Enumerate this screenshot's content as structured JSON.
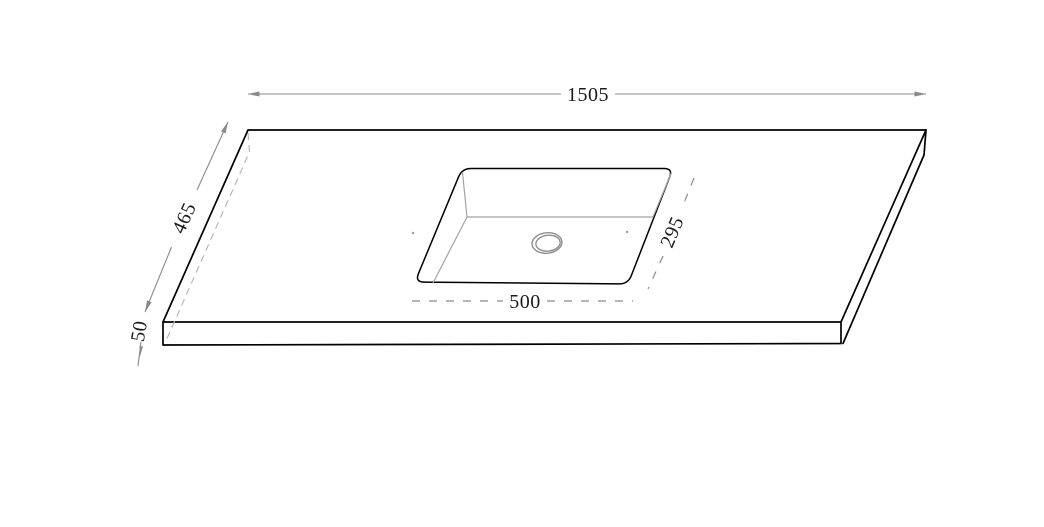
{
  "drawing": {
    "type": "countertop-with-undermount-sink-technical-drawing",
    "dimensions": {
      "overall_width": "1505",
      "overall_depth": "465",
      "thickness": "50",
      "sink_width": "500",
      "sink_depth": "295"
    },
    "colors": {
      "background": "#ffffff",
      "outline": "#000000",
      "dimension_line": "#8a8a8a",
      "hidden_edge": "#b8b8b8",
      "interior_edge": "#a3a3a3",
      "dimension_text": "#1b1b1b"
    }
  }
}
